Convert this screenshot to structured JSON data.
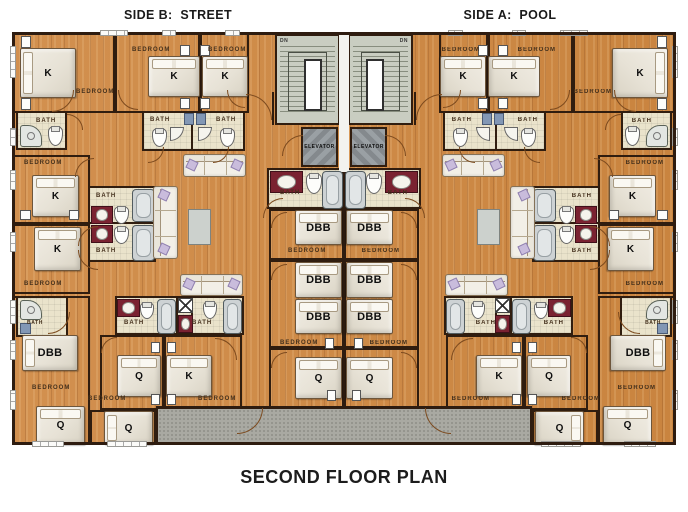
{
  "titles": {
    "side_b": "SIDE B:  STREET",
    "side_a": "SIDE A:  POOL",
    "plan": "SECOND FLOOR PLAN"
  },
  "labels": {
    "bedroom": "BEDROOM",
    "bath": "BATH",
    "elevator": "ELEVATOR",
    "down": "DN",
    "bed_king": "K",
    "bed_queen": "Q",
    "bed_double_bunk": "DBB"
  },
  "halves": {
    "left": "Side B - Street",
    "right": "Side A - Pool"
  },
  "colors": {
    "wall": "#2e1c10",
    "wood_floor": "#cf8c4d",
    "bath_floor": "#eae3cb",
    "stairwell": "#c9cdc1",
    "elevator_car": "#93999d",
    "deck": "#a9a9a2",
    "sink_counter_maroon": "#7a2231",
    "pillow_accent": "#c9bcdc",
    "fixture_blue": "#8297b5"
  }
}
